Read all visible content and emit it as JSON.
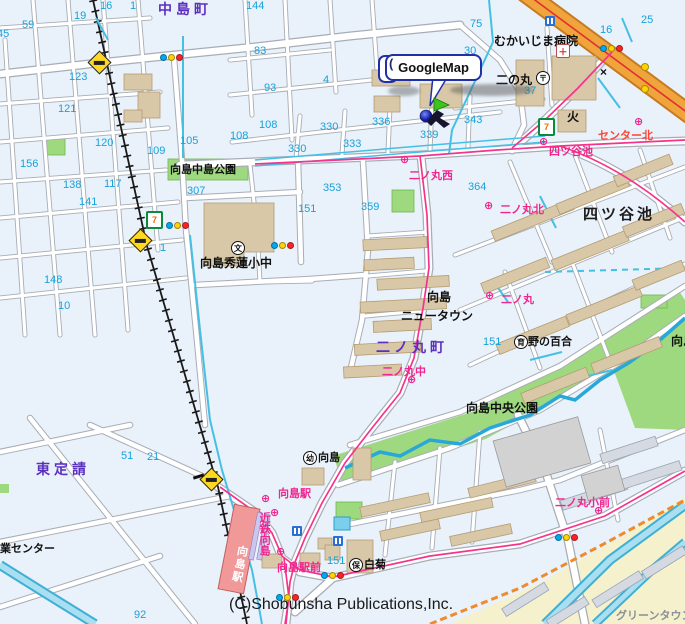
{
  "map": {
    "balloon": {
      "label": "GoogleMap"
    },
    "icons": {
      "seven_eleven": "7",
      "post_office": "〒",
      "school": "文",
      "fire_station": "火",
      "koban": "×",
      "hospital": "＋",
      "kindergarten": "幼",
      "nursery": "保",
      "care_home": "育",
      "bus_stop": "⊕",
      "balloon_curl": "("
    },
    "colors": {
      "road_fill": "#ffffff",
      "road_casing": "#a8adb5",
      "water": "#45c0e4",
      "park_green": "#9fd97f",
      "building_tan": "#d8c8a8",
      "building_gray": "#d4d9e2",
      "highway_orange": "#f0a43c",
      "bus_route_pink": "#f5338f",
      "boundary_orange": "#ef8b2a",
      "district_purple": "#5b2fc0",
      "number_cyan": "#18a2da",
      "bus_magenta": "#f0258e",
      "station_red": "#f19999",
      "background": "#e9f1fa",
      "newtown_yellow": "#f5f1cc"
    },
    "labels": [
      {
        "name": "label-nakajima-cho",
        "text": "中島町",
        "kind": "district",
        "x": 158,
        "y": 2
      },
      {
        "name": "label-higashi-sadauke",
        "text": "東定請",
        "kind": "district",
        "x": 36,
        "y": 462
      },
      {
        "name": "label-ninomaru-cho",
        "text": "二ノ丸町",
        "kind": "district",
        "x": 376,
        "y": 340
      },
      {
        "name": "label-yotsuya-ike",
        "text": "四ツ谷池",
        "kind": "pond",
        "x": 583,
        "y": 206
      },
      {
        "name": "label-mukaijima-hospital",
        "text": "むかいじま病院",
        "kind": "place",
        "x": 494,
        "y": 35
      },
      {
        "name": "label-ninomaru",
        "text": "二の丸",
        "kind": "place",
        "x": 496,
        "y": 74
      },
      {
        "name": "label-shuren-school",
        "text": "向島秀蓮小中",
        "kind": "place",
        "x": 200,
        "y": 257
      },
      {
        "name": "label-newtown-line1",
        "text": "向島",
        "kind": "place",
        "x": 427,
        "y": 291
      },
      {
        "name": "label-newtown-line2",
        "text": "ニュータウン",
        "kind": "place",
        "x": 401,
        "y": 310
      },
      {
        "name": "label-chuo-koen",
        "text": "向島中央公園",
        "kind": "place",
        "x": 466,
        "y": 402
      },
      {
        "name": "label-chuo-koen-east",
        "text": "向島中央公園",
        "kind": "place",
        "x": 671,
        "y": 335
      },
      {
        "name": "label-nakajima-koen",
        "text": "向島中島公園",
        "kind": "small",
        "x": 170,
        "y": 164
      },
      {
        "name": "label-nono-yuri",
        "text": "野の百合",
        "kind": "small",
        "x": 528,
        "y": 336
      },
      {
        "name": "label-shiragiku",
        "text": "白菊",
        "kind": "small",
        "x": 364,
        "y": 559
      },
      {
        "name": "label-mukaijima-yochien",
        "text": "向島",
        "kind": "small",
        "x": 318,
        "y": 452
      },
      {
        "name": "label-gyo-center",
        "text": "業センター",
        "kind": "small",
        "x": 0,
        "y": 543
      },
      {
        "name": "label-green-town",
        "text": "グリーンタウン",
        "kind": "muted",
        "x": 616,
        "y": 610
      },
      {
        "name": "label-bus-yotsuya-ike",
        "text": "四ツ谷池",
        "kind": "bus",
        "x": 549,
        "y": 146
      },
      {
        "name": "label-bus-ninomaru-nishi",
        "text": "二ノ丸西",
        "kind": "bus",
        "x": 409,
        "y": 170
      },
      {
        "name": "label-bus-ninomaru-kita",
        "text": "二ノ丸北",
        "kind": "bus",
        "x": 500,
        "y": 204
      },
      {
        "name": "label-bus-ninomaru",
        "text": "二ノ丸",
        "kind": "bus",
        "x": 501,
        "y": 294
      },
      {
        "name": "label-bus-ninomaru-naka",
        "text": "二ノ丸中",
        "kind": "bus",
        "x": 382,
        "y": 366
      },
      {
        "name": "label-bus-mukaijima-eki",
        "text": "向島駅",
        "kind": "bus",
        "x": 278,
        "y": 488
      },
      {
        "name": "label-bus-kintetsu-mukaijima",
        "text": "近鉄向島",
        "kind": "busv",
        "x": 258,
        "y": 512
      },
      {
        "name": "label-bus-mukaijima-ekimae",
        "text": "向島駅前",
        "kind": "bus",
        "x": 277,
        "y": 562
      },
      {
        "name": "label-bus-ninomaru-sho-mae",
        "text": "二ノ丸小前",
        "kind": "bus",
        "x": 555,
        "y": 497
      },
      {
        "name": "label-bus-center-kita",
        "text": "センター北",
        "kind": "busred",
        "x": 598,
        "y": 130
      },
      {
        "name": "label-mukaijima-station",
        "text": "向島駅",
        "kind": "station",
        "x": 233,
        "y": 545
      },
      {
        "name": "copyright-text",
        "text": "(C)Shobunsha Publications,Inc.",
        "kind": "copyright",
        "x": 229,
        "y": 596
      },
      {
        "name": "block-number",
        "text": "16",
        "kind": "number",
        "x": 100,
        "y": 0
      },
      {
        "name": "block-number",
        "text": "1",
        "kind": "number",
        "x": 130,
        "y": 0
      },
      {
        "name": "block-number",
        "text": "19",
        "kind": "number",
        "x": 74,
        "y": 10
      },
      {
        "name": "block-number",
        "text": "59",
        "kind": "number",
        "x": 22,
        "y": 19
      },
      {
        "name": "block-number",
        "text": "45",
        "kind": "number",
        "x": -3,
        "y": 28
      },
      {
        "name": "block-number",
        "text": "144",
        "kind": "number",
        "x": 246,
        "y": 0
      },
      {
        "name": "block-number",
        "text": "123",
        "kind": "number",
        "x": 69,
        "y": 71
      },
      {
        "name": "block-number",
        "text": "121",
        "kind": "number",
        "x": 58,
        "y": 103
      },
      {
        "name": "block-number",
        "text": "120",
        "kind": "number",
        "x": 95,
        "y": 137
      },
      {
        "name": "block-number",
        "text": "105",
        "kind": "number",
        "x": 180,
        "y": 135
      },
      {
        "name": "block-number",
        "text": "109",
        "kind": "number",
        "x": 147,
        "y": 145
      },
      {
        "name": "block-number",
        "text": "156",
        "kind": "number",
        "x": 20,
        "y": 158
      },
      {
        "name": "block-number",
        "text": "83",
        "kind": "number",
        "x": 254,
        "y": 45
      },
      {
        "name": "block-number",
        "text": "93",
        "kind": "number",
        "x": 264,
        "y": 82
      },
      {
        "name": "block-number",
        "text": "4",
        "kind": "number",
        "x": 323,
        "y": 74
      },
      {
        "name": "block-number",
        "text": "108",
        "kind": "number",
        "x": 259,
        "y": 119
      },
      {
        "name": "block-number",
        "text": "108",
        "kind": "number",
        "x": 230,
        "y": 130
      },
      {
        "name": "block-number",
        "text": "330",
        "kind": "number",
        "x": 320,
        "y": 121
      },
      {
        "name": "block-number",
        "text": "330",
        "kind": "number",
        "x": 288,
        "y": 143
      },
      {
        "name": "block-number",
        "text": "333",
        "kind": "number",
        "x": 343,
        "y": 138
      },
      {
        "name": "block-number",
        "text": "336",
        "kind": "number",
        "x": 372,
        "y": 116
      },
      {
        "name": "block-number",
        "text": "339",
        "kind": "number",
        "x": 420,
        "y": 129
      },
      {
        "name": "block-number",
        "text": "343",
        "kind": "number",
        "x": 464,
        "y": 114
      },
      {
        "name": "block-number",
        "text": "30",
        "kind": "number",
        "x": 464,
        "y": 45
      },
      {
        "name": "block-number",
        "text": "75",
        "kind": "number",
        "x": 470,
        "y": 18
      },
      {
        "name": "block-number",
        "text": "16",
        "kind": "number",
        "x": 600,
        "y": 24
      },
      {
        "name": "block-number",
        "text": "25",
        "kind": "number",
        "x": 641,
        "y": 14
      },
      {
        "name": "block-number",
        "text": "37",
        "kind": "number",
        "x": 524,
        "y": 85
      },
      {
        "name": "block-number",
        "text": "138",
        "kind": "number",
        "x": 63,
        "y": 179
      },
      {
        "name": "block-number",
        "text": "117",
        "kind": "number",
        "x": 104,
        "y": 178
      },
      {
        "name": "block-number",
        "text": "141",
        "kind": "number",
        "x": 79,
        "y": 196
      },
      {
        "name": "block-number",
        "text": "307",
        "kind": "number",
        "x": 187,
        "y": 185
      },
      {
        "name": "block-number",
        "text": "148",
        "kind": "number",
        "x": 44,
        "y": 274
      },
      {
        "name": "block-number",
        "text": "10",
        "kind": "number",
        "x": 58,
        "y": 300
      },
      {
        "name": "block-number",
        "text": "1",
        "kind": "number",
        "x": 160,
        "y": 242
      },
      {
        "name": "block-number",
        "text": "353",
        "kind": "number",
        "x": 323,
        "y": 182
      },
      {
        "name": "block-number",
        "text": "359",
        "kind": "number",
        "x": 361,
        "y": 201
      },
      {
        "name": "block-number",
        "text": "364",
        "kind": "number",
        "x": 468,
        "y": 181
      },
      {
        "name": "block-number",
        "text": "151",
        "kind": "number",
        "x": 298,
        "y": 203
      },
      {
        "name": "block-number",
        "text": "151",
        "kind": "number",
        "x": 483,
        "y": 336
      },
      {
        "name": "block-number",
        "text": "151",
        "kind": "number",
        "x": 327,
        "y": 555
      },
      {
        "name": "block-number",
        "text": "51",
        "kind": "number",
        "x": 121,
        "y": 450
      },
      {
        "name": "block-number",
        "text": "21",
        "kind": "number",
        "x": 147,
        "y": 451
      },
      {
        "name": "block-number",
        "text": "92",
        "kind": "number",
        "x": 134,
        "y": 609
      }
    ],
    "traffic_lights": [
      {
        "x": 160,
        "y": 54
      },
      {
        "x": 600,
        "y": 45
      },
      {
        "x": 166,
        "y": 222
      },
      {
        "x": 271,
        "y": 242
      },
      {
        "x": 321,
        "y": 572
      },
      {
        "x": 555,
        "y": 534
      },
      {
        "x": 276,
        "y": 594
      }
    ],
    "signal_lamps": [
      {
        "x": 641,
        "y": 63
      },
      {
        "x": 641,
        "y": 85
      }
    ],
    "crossings": [
      {
        "x": 91,
        "y": 54
      },
      {
        "x": 132,
        "y": 232
      },
      {
        "x": 203,
        "y": 471
      }
    ],
    "crossing_gates": [
      {
        "x": 193,
        "y": 475
      }
    ],
    "seven_elevens": [
      {
        "x": 146,
        "y": 211
      },
      {
        "x": 538,
        "y": 118
      }
    ],
    "bus_stops": [
      {
        "x": 400,
        "y": 153
      },
      {
        "x": 484,
        "y": 199
      },
      {
        "x": 485,
        "y": 289
      },
      {
        "x": 407,
        "y": 373
      },
      {
        "x": 539,
        "y": 135
      },
      {
        "x": 634,
        "y": 115
      },
      {
        "x": 594,
        "y": 504
      },
      {
        "x": 261,
        "y": 492
      },
      {
        "x": 270,
        "y": 506
      },
      {
        "x": 276,
        "y": 545
      }
    ],
    "blue_facilities": [
      {
        "x": 545,
        "y": 16
      },
      {
        "x": 292,
        "y": 516
      },
      {
        "x": 333,
        "y": 516
      }
    ]
  }
}
